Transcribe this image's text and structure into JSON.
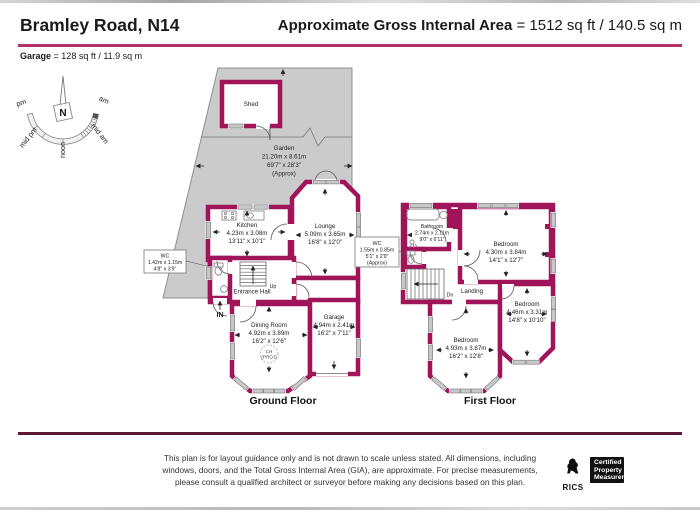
{
  "header": {
    "title": "Bramley Road, N14",
    "gia_label": "Approximate Gross Internal Area",
    "gia_value": "= 1512 sq ft / 140.5 sq m"
  },
  "garage_note": {
    "label": "Garage",
    "value": "= 128 sq ft / 11.9 sq m"
  },
  "compass": {
    "north": "N",
    "am": "am",
    "pm": "pm",
    "mid_am": "mid am",
    "mid_pm": "mid pm",
    "noon": "noon"
  },
  "garden": {
    "name": "Garden",
    "metric": "21.20m x 8.61m",
    "imperial": "69'7\" x 28'3\"",
    "approx": "(Approx)"
  },
  "shed": {
    "name": "Shed"
  },
  "ground_floor": {
    "label": "Ground Floor",
    "kitchen": {
      "name": "Kitchen",
      "metric": "4.23m x 3.08m",
      "imperial": "13'11\" x 10'1\""
    },
    "lounge": {
      "name": "Lounge",
      "metric": "5.09m x 3.65m",
      "imperial": "16'8\" x 12'0\""
    },
    "wc": {
      "name": "WC",
      "metric": "1.42m x 1.15m",
      "imperial": "4'8\" x 3'9\""
    },
    "entrance_hall": {
      "name": "Entrance Hall"
    },
    "dining_room": {
      "name": "Dining Room",
      "metric": "4.92m x 3.89m",
      "imperial": "16'2\" x 12'6\""
    },
    "garage": {
      "name": "Garage",
      "metric": "4.94m x 2.41m",
      "imperial": "16'2\" x 7'11\""
    },
    "stairs_label": "Up",
    "entrance_label": "IN",
    "ch_marker": {
      "line1": "CH",
      "line2": "(PROJ)"
    }
  },
  "first_floor": {
    "label": "First Floor",
    "bathroom": {
      "name": "Bathroom",
      "metric": "2.74m x 2.11m",
      "imperial": "9'0\" x 6'11\""
    },
    "bedroom1": {
      "name": "Bedroom",
      "metric": "4.30m x 3.84m",
      "imperial": "14'1\" x 12'7\""
    },
    "bedroom2": {
      "name": "Bedroom",
      "metric": "4.93m x 3.87m",
      "imperial": "16'2\" x 12'8\""
    },
    "bedroom3": {
      "name": "Bedroom",
      "metric": "4.46m x 3.31m",
      "imperial": "14'8\" x 10'10\""
    },
    "wc": {
      "name": "WC",
      "metric": "1.55m x 0.85m",
      "imperial": "5'1\" x 2'9\"",
      "approx": "(Approx)"
    },
    "landing": {
      "name": "Landing"
    },
    "stairs_label": "Dn"
  },
  "footer": {
    "disclaimer_line1": "This plan is for layout guidance only and is not drawn to scale unless stated. All dimensions, including",
    "disclaimer_line2": "windows, doors, and the Total Gross Internal Area (GIA), are approximate. For precise measurements,",
    "disclaimer_line3": "please consult a qualified architect or surveyor before making any decisions based on this plan.",
    "rics_label": "RICS",
    "badge_line1": "Certified",
    "badge_line2": "Property",
    "badge_line3": "Measurer"
  },
  "colors": {
    "wall": "#A0145A",
    "window": "#C8C8C8",
    "garden": "#CBCBCB",
    "header_rule": "#B5316B",
    "footer_rule": "#5E1637"
  }
}
